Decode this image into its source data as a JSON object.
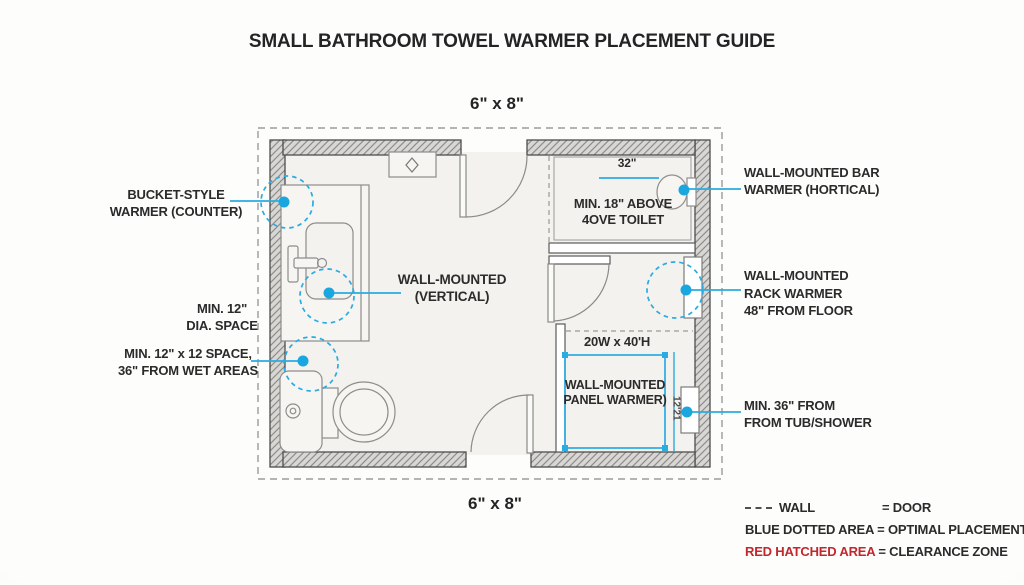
{
  "title": "SMALL BATHROOM TOWEL WARMER PLACEMENT GUIDE",
  "dims": {
    "top": "6\" x 8\"",
    "bottom": "6\" x 8\""
  },
  "callouts": {
    "bucket": [
      "BUCKET-STYLE",
      "WARMER (COUNTER)"
    ],
    "dia": [
      "MIN. 12\"",
      "DIA. SPACE"
    ],
    "space12": [
      "MIN. 12\" x 12 SPACE,",
      "36\" FROM WET AREAS"
    ],
    "bar": [
      "WALL-MOUNTED BAR",
      "WARMER (HORTICAL)"
    ],
    "rack": [
      "WALL-MOUNTED",
      "RACK WARMER",
      "48\" FROM FLOOR"
    ],
    "tub": [
      "MIN. 36\" FROM",
      "FROM TUB/SHOWER"
    ]
  },
  "plan": {
    "toilet_dim": "32\"",
    "toilet_note": [
      "MIN. 18\" ABOVE",
      "4OVE TOILET"
    ],
    "vertical_label": [
      "WALL-MOUNTED",
      "(VERTICAL)"
    ],
    "panel_dim": "20W x 40'H",
    "panel_label": [
      "WALL-MOUNTED",
      "PANEL WARMER)"
    ],
    "panel_side_dim": "12'21"
  },
  "legend": {
    "wall_label": "WALL",
    "door_label": "= DOOR",
    "blue_label": "BLUE DOTTED AREA",
    "blue_value": "= OPTIMAL PLACEMENT",
    "red_label": "RED HATCHED AREA",
    "red_value": "= CLEARANCE ZONE"
  },
  "colors": {
    "accent": "#2aabe2",
    "dot": "#1aa7e0",
    "red": "#c1272d"
  },
  "icons": [
    "wall-dash-symbol",
    "optimal-placement-dot",
    "placement-dotted-circle"
  ]
}
